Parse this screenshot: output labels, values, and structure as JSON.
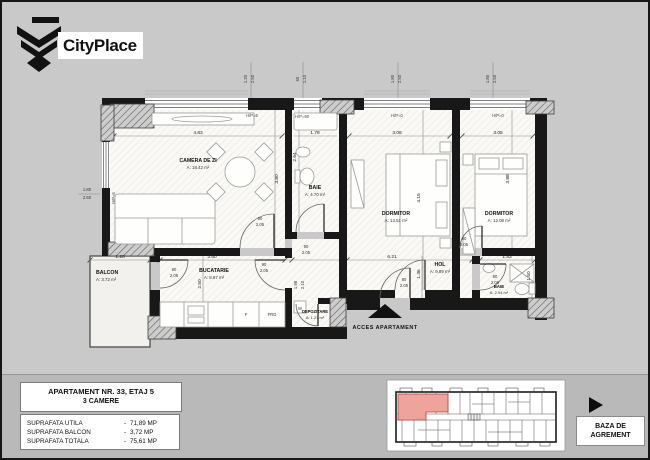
{
  "logo": {
    "brand": "CityPlace"
  },
  "plan": {
    "rooms": [
      {
        "name": "CAMERA DE ZI",
        "area": "A: 18.42 m²"
      },
      {
        "name": "BAIE",
        "area": "A: 4.70 m²"
      },
      {
        "name": "DORMITOR",
        "area": "A: 13.51 m²"
      },
      {
        "name": "DORMITOR",
        "area": "A: 12.08 m²"
      },
      {
        "name": "BALCON",
        "area": "A: 3.72 m²"
      },
      {
        "name": "BUCATARIE",
        "area": "A: 8.97 m²"
      },
      {
        "name": "DEPOZITARE",
        "area": "A: 1.27 m²"
      },
      {
        "name": "HOL",
        "area": "A: 9.89 m²"
      },
      {
        "name": "BAIE",
        "area": "A: 2.94 m²"
      }
    ],
    "dims": {
      "living_w": "4.83",
      "living_h": "3.80",
      "baie1_w": "1.78",
      "baie1_h": "2.64",
      "dorm1_w": "3.08",
      "dorm1_h": "4.15",
      "dorm2_w": "3.05",
      "dorm2_h": "3.88",
      "balcon_w": "1.20",
      "buc_w": "3.60",
      "buc_h": "2.50",
      "hol_w": "6.21",
      "hol_h": "1.36",
      "baie2_w": "1.83",
      "baie2_h": "1.60",
      "dep_a": "1.98",
      "dep_b": "2.10"
    },
    "window_tags": {
      "t1a": "1.20",
      "t1b": "2.50",
      "t2a": "60",
      "t2b": "1.10",
      "t3a": "1.80",
      "t3b": "2.50",
      "t4a": "1.80",
      "t4b": "2.50",
      "left_a": "1.80",
      "left_b": "2.50"
    },
    "hp_labels": {
      "living": "H/P=5",
      "baie1": "H/P=90",
      "dorm1": "H/P=0",
      "dorm2": "H/P=0",
      "side": "H/P=5"
    },
    "door_tags": {
      "living_a": "90",
      "living_b": "2.05",
      "kitchen_a": "90",
      "kitchen_b": "2.05",
      "balcony_a": "90",
      "balcony_b": "2.06",
      "baie1_a": "90",
      "baie1_b": "2.05",
      "dorm1_a": "80",
      "dorm1_b": "2.05",
      "dorm2_a": "90",
      "dorm2_b": "2.05",
      "baie2_a": "80",
      "baie2_b": "2.05"
    },
    "appliances": {
      "fridge": "FRG",
      "stove": "F",
      "washer": "W"
    },
    "access_label": "ACCES APARTAMENT"
  },
  "title_block": {
    "line1": "APARTAMENT NR. 33, ETAJ 5",
    "line2": "3 CAMERE"
  },
  "areas_table": {
    "dash": "-",
    "rows": [
      {
        "label": "SUPRAFATA UTILA",
        "value": "71,89 MP"
      },
      {
        "label": "SUPRAFATA BALCON",
        "value": "3,72 MP"
      },
      {
        "label": "SUPRAFATA TOTALA",
        "value": "75,61 MP"
      }
    ]
  },
  "agrement": {
    "line1": "BAZA DE",
    "line2": "AGREMENT"
  },
  "colors": {
    "background": "#c9c9c9",
    "strip": "#b9b9b9",
    "wall": "#181818",
    "highlight": "#efa49b"
  }
}
